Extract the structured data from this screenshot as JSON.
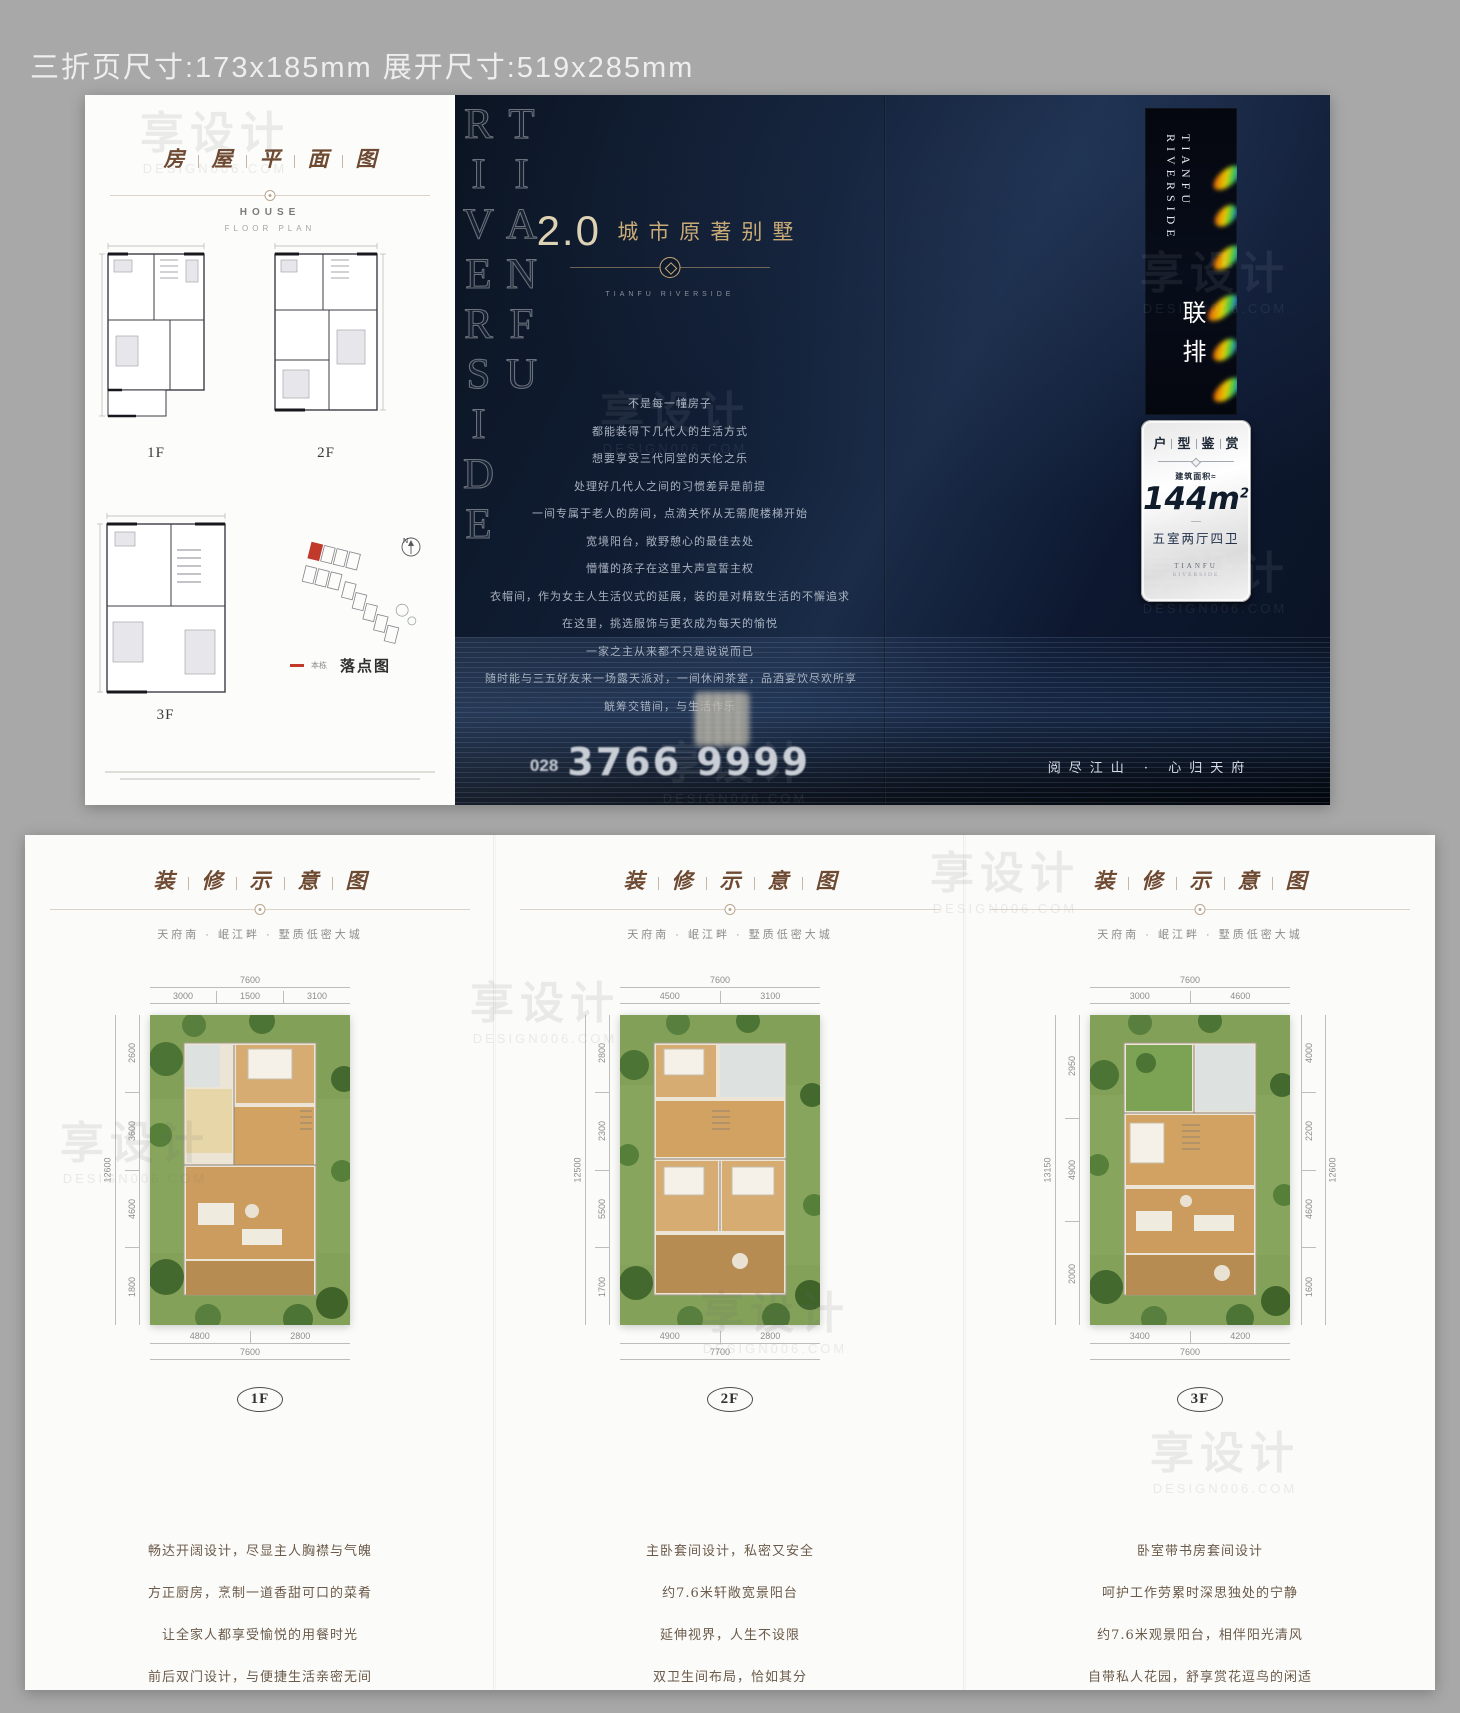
{
  "mockup": {
    "caption": "三折页尺寸:173x185mm  展开尺寸:519x285mm",
    "stray_label": "图",
    "watermark": {
      "text": "享设计",
      "sub": "DESIGN006.COM"
    }
  },
  "colors": {
    "mockup_bg": "#a8a8a8",
    "navy": "#0e1a2e",
    "accent_gold": "#c9ab77",
    "title_brown": "#6f4a33",
    "highlight_red": "#c0392b",
    "garden_green": "#87a55d"
  },
  "front": {
    "left_panel": {
      "title_chars": [
        "房",
        "屋",
        "平",
        "面",
        "图"
      ],
      "subtitle_en": "HOUSE",
      "subtitle_en2": "FLOOR PLAN",
      "floor_labels": [
        "1F",
        "2F",
        "3F"
      ],
      "site": {
        "compass": "N",
        "legend": "本栋",
        "label": "落点图"
      }
    },
    "middle_panel": {
      "edge_vertical_text": "TIANFU RIVERSIDE",
      "headline_prefix": "2.0",
      "headline": "城市原著别墅",
      "brand_caption": "TIANFU RIVERSIDE",
      "body_lines": [
        "不是每一幢房子",
        "都能装得下几代人的生活方式",
        "想要享受三代同堂的天伦之乐",
        "处理好几代人之间的习惯差异是前提",
        "一间专属于老人的房间，点滴关怀从无需爬楼梯开始",
        "宽境阳台，敞野憩心的最佳去处",
        "懵懂的孩子在这里大声宣誓主权",
        "衣帽间，作为女主人生活仪式的延展，装的是对精致生活的不懈追求",
        "在这里，挑选服饰与更衣成为每天的愉悦",
        "一家之主从来都不只是说说而已",
        "随时能与三五好友来一场露天派对，一间休闲茶室，品酒宴饮尽欢所享",
        "觥筹交错间，与生活作乐"
      ],
      "hotline_prefix": "028",
      "hotline_number": "3766 9999"
    },
    "right_panel": {
      "strip_vertical_text": "TIANFU RIVERSIDE",
      "product_type": "联排",
      "card": {
        "title_chars": [
          "户",
          "型",
          "鉴",
          "赏"
        ],
        "area_label": "建筑面积≈",
        "area_value": "144m",
        "area_sup": "2",
        "layout": "五室两厅四卫",
        "brand": "TIANFU",
        "brand_sub": "RIVERSIDE"
      },
      "slogan": "阅尽江山 · 心归天府"
    }
  },
  "back": {
    "panels": [
      {
        "title_chars": [
          "装",
          "修",
          "示",
          "意",
          "图"
        ],
        "subtitle": "天府南 · 岷江畔 · 墅质低密大城",
        "floor": "1F",
        "dims": {
          "top_total": "7600",
          "top_segs": [
            "3000",
            "1500",
            "3100"
          ],
          "left_total": "12600",
          "left_segs": [
            "2600",
            "3600",
            "4600",
            "1800"
          ],
          "bottom_total": "7600",
          "bottom_segs": [
            "4800",
            "2800"
          ]
        },
        "desc": [
          "畅达开阔设计，尽显主人胸襟与气魄",
          "方正厨房，烹制一道香甜可口的菜肴",
          "让全家人都享受愉悦的用餐时光",
          "前后双门设计，与便捷生活亲密无间"
        ]
      },
      {
        "title_chars": [
          "装",
          "修",
          "示",
          "意",
          "图"
        ],
        "subtitle": "天府南 · 岷江畔 · 墅质低密大城",
        "floor": "2F",
        "dims": {
          "top_total": "7600",
          "top_segs": [
            "4500",
            "3100"
          ],
          "left_total": "12500",
          "left_segs": [
            "2800",
            "2300",
            "5500",
            "1700"
          ],
          "bottom_total": "7700",
          "bottom_segs": [
            "4900",
            "2800"
          ]
        },
        "desc": [
          "主卧套间设计，私密又安全",
          "约7.6米轩敞宽景阳台",
          "延伸视界，人生不设限",
          "双卫生间布局，恰如其分"
        ]
      },
      {
        "title_chars": [
          "装",
          "修",
          "示",
          "意",
          "图"
        ],
        "subtitle": "天府南 · 岷江畔 · 墅质低密大城",
        "floor": "3F",
        "dims": {
          "top_total": "7600",
          "top_segs": [
            "3000",
            "4600"
          ],
          "left_total": "13150",
          "left_segs": [
            "2950",
            "4900",
            "2000"
          ],
          "right_total": "12600",
          "right_segs": [
            "4000",
            "2200",
            "4600",
            "1600"
          ],
          "bottom_total": "7600",
          "bottom_segs": [
            "3400",
            "4200"
          ]
        },
        "desc": [
          "卧室带书房套间设计",
          "呵护工作劳累时深思独处的宁静",
          "约7.6米观景阳台，相伴阳光清风",
          "自带私人花园，舒享赏花逗鸟的闲适"
        ]
      }
    ]
  }
}
